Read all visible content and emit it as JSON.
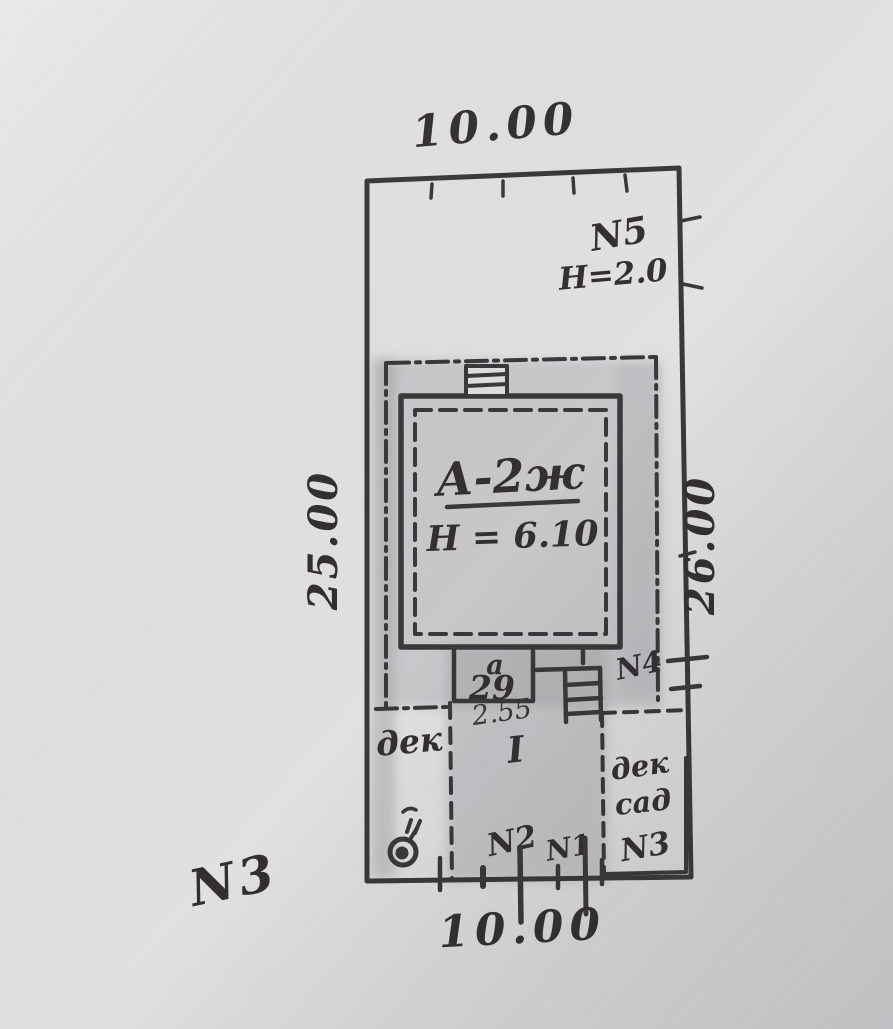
{
  "drawing_type": "hand-drawn cadastral site plan",
  "dimensions": {
    "top": "10.00",
    "bottom": "10.00",
    "left": "25.00",
    "right": "26.00"
  },
  "markers": {
    "n5": "N5",
    "n5_height": "Н=2.0",
    "n4": "N4",
    "n3_outside": "N3"
  },
  "building": {
    "type_label": "А-2ж",
    "height_label": "Н = 6.10",
    "section_mark": "I"
  },
  "porch": {
    "letter": "а",
    "number": "29",
    "width": "2.55"
  },
  "rooms": {
    "left_label": "дек",
    "right_line1": "дек",
    "right_line2": "сад",
    "right_number": "N3"
  },
  "survey_points": {
    "n2": "N2",
    "n1": "N1"
  },
  "colors": {
    "ink": "#3a383a",
    "paper": "#e4e3e5",
    "building_fill": "#e8c6c9",
    "pencil_shade": "#98989a"
  }
}
